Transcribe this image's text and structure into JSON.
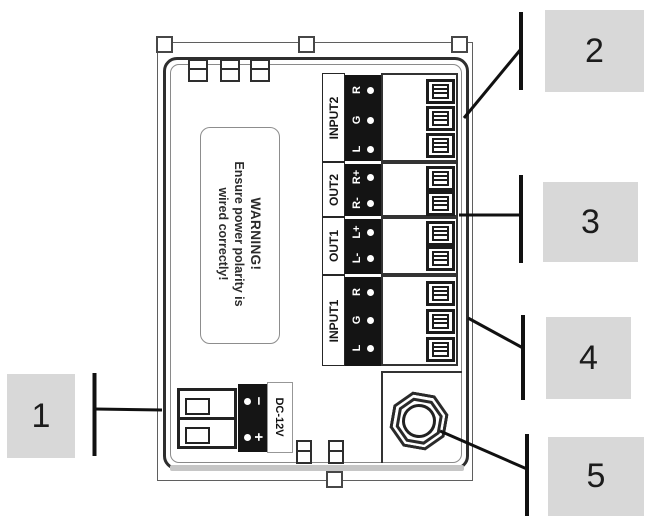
{
  "callouts": {
    "labels": [
      "1",
      "2",
      "3",
      "4",
      "5"
    ]
  },
  "device": {
    "warning_label": {
      "title": "WARNING!",
      "line1": "Ensure power polarity is",
      "line2": "wired correctly!"
    },
    "terminal_groups": [
      {
        "name": "INPUT2",
        "pins": [
          "R",
          "G",
          "L"
        ]
      },
      {
        "name": "OUT2",
        "pins": [
          "R+",
          "R-"
        ]
      },
      {
        "name": "OUT1",
        "pins": [
          "L+",
          "L-"
        ]
      },
      {
        "name": "INPUT1",
        "pins": [
          "R",
          "G",
          "L"
        ]
      }
    ],
    "power": {
      "label": "DC-12V",
      "negative": "−",
      "positive": "+"
    }
  }
}
